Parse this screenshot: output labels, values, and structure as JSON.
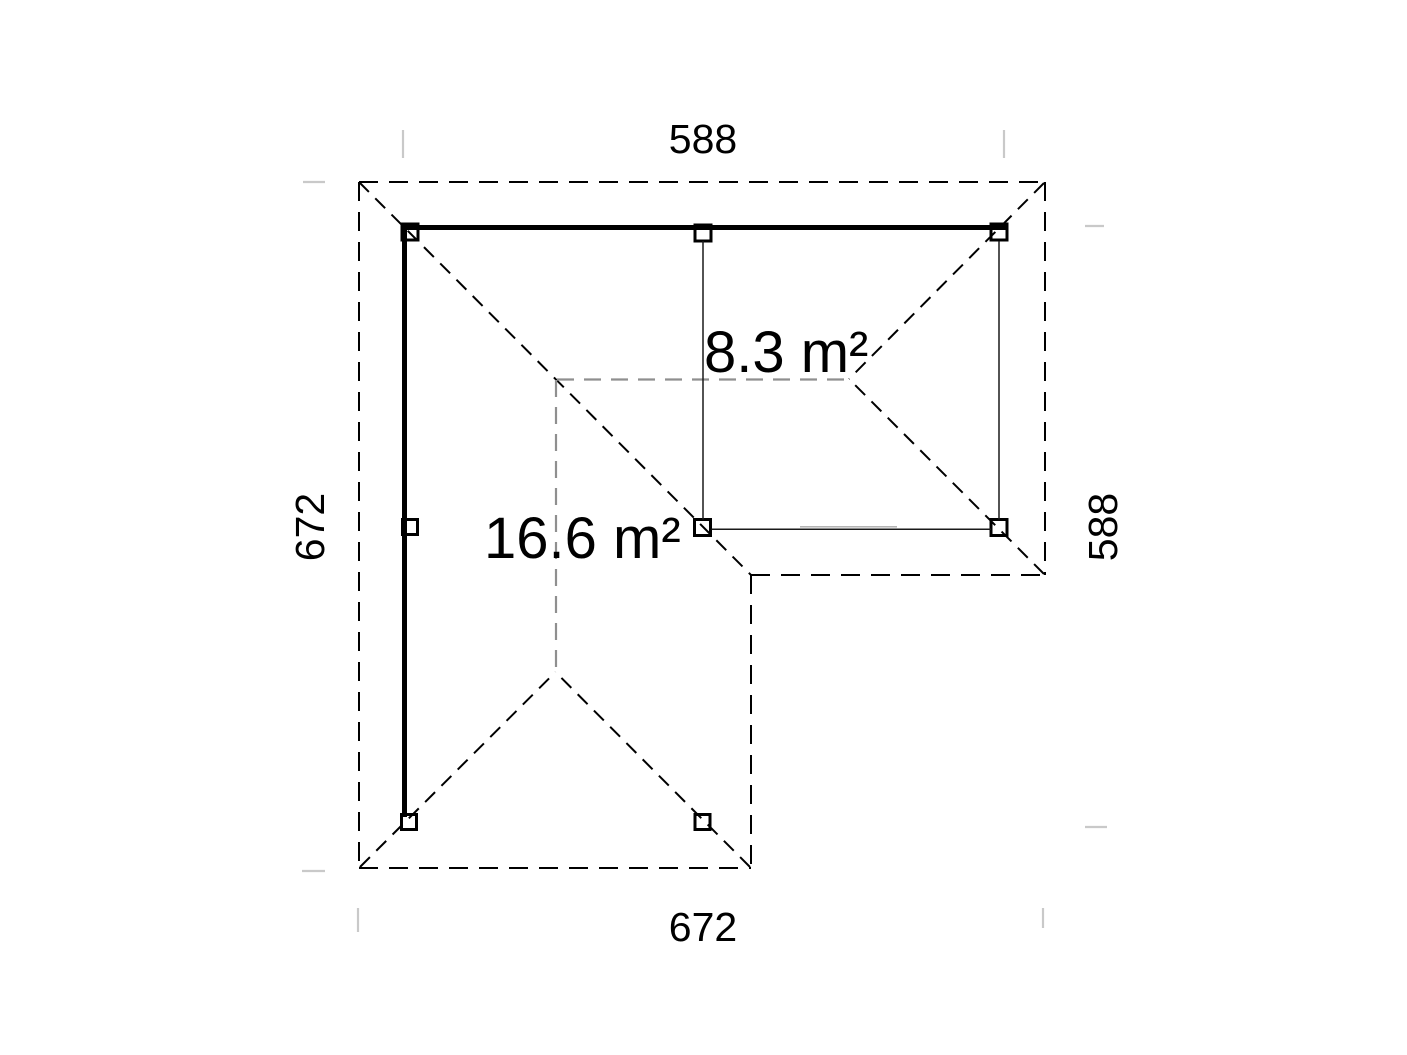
{
  "floor_plan": {
    "dimension_labels": {
      "top": "588",
      "bottom": "672",
      "left": "672",
      "right": "588"
    },
    "area_labels": {
      "main": "16.6 m²",
      "annex": "8.3 m²"
    },
    "colors": {
      "line": "#000000",
      "ridge": "#8f8f8f",
      "tick": "#c9c9c9",
      "text": "#000000",
      "background": "#ffffff"
    }
  }
}
